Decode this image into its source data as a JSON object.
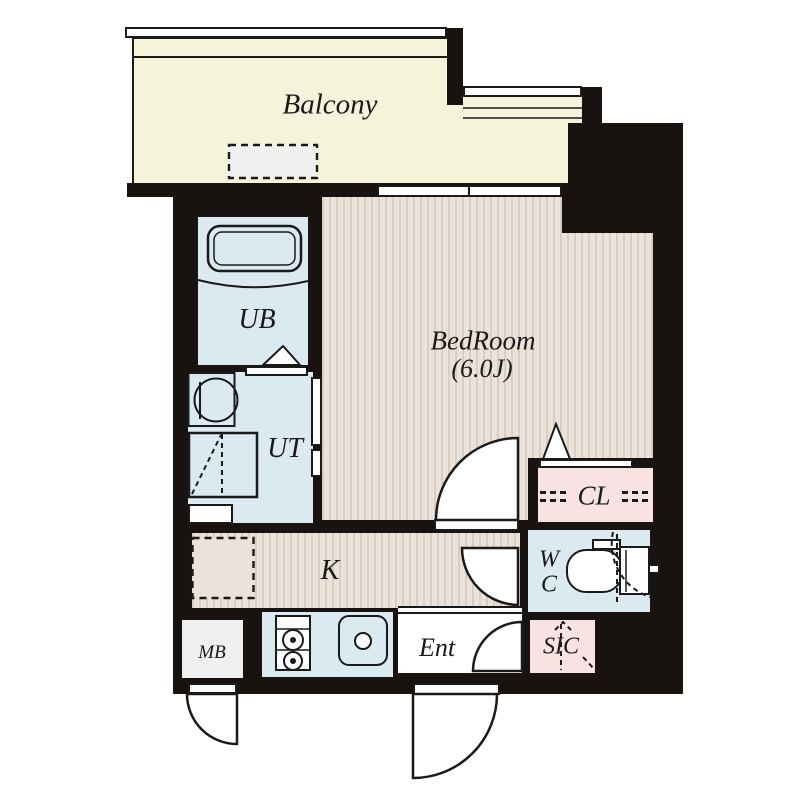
{
  "plan": {
    "title": "studio-apartment-floor-plan",
    "rooms": {
      "balcony": {
        "label": "Balcony"
      },
      "bedroom": {
        "label": "BedRoom",
        "size": "(6.0J)"
      },
      "unit_bath": {
        "label": "UB"
      },
      "utility": {
        "label": "UT"
      },
      "kitchen": {
        "label": "K"
      },
      "closet": {
        "label": "CL"
      },
      "wc": {
        "label": "W\nC"
      },
      "entrance": {
        "label": "Ent"
      },
      "shoe_closet": {
        "label": "SIC"
      },
      "meter_box": {
        "label": "MB"
      }
    },
    "colors": {
      "wall": "#181310",
      "line": "#1a1a1a",
      "balcony": "#f5f3da",
      "floor": "#ebe3da",
      "stripe": "#d9cec4",
      "wet": "#dbe9f1",
      "pink": "#f8e2e2",
      "white": "#ffffff",
      "gray": "#f0f0f0"
    }
  }
}
